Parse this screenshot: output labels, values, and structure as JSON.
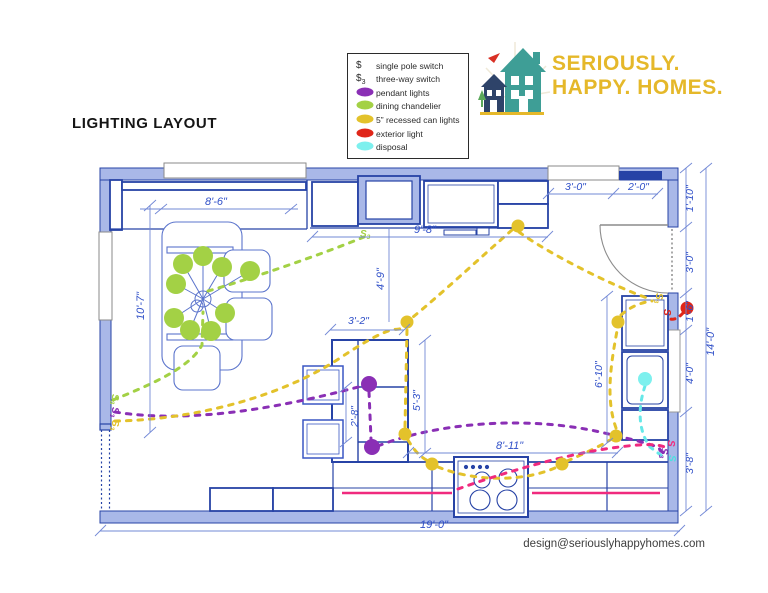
{
  "title": "LIGHTING LAYOUT",
  "legend": {
    "switch_items": [
      {
        "symbol": "$",
        "sub": "",
        "label": "single pole switch"
      },
      {
        "symbol": "$",
        "sub": "3",
        "label": "three-way switch"
      }
    ],
    "light_items": [
      {
        "label": "pendant lights",
        "color": "#8a2fb5"
      },
      {
        "label": "dining chandelier",
        "color": "#a3d145"
      },
      {
        "label": "5” recessed can lights",
        "color": "#e3c22b"
      },
      {
        "label": "exterior light",
        "color": "#e02619"
      },
      {
        "label": "disposal",
        "color": "#7df0ee"
      }
    ]
  },
  "logo": {
    "line1": "SERIOUSLY.",
    "line2": "HAPPY. HOMES."
  },
  "footer": {
    "email": "design@seriouslyhappyhomes.com"
  },
  "glyphs": {
    "s": "S",
    "three": "3"
  },
  "dims": {
    "top_left_window": "8'-6\"",
    "top_run": "9'-8\"",
    "left_wall": "10'-7\"",
    "entry_window_a": "3'-0\"",
    "entry_window_b": "2'-0\"",
    "right_top": "1'-10\"",
    "right_door": "3'-0\"",
    "right_exterior": "1'-6\"",
    "right_window": "4'-0\"",
    "right_bottom": "3'-8\"",
    "right_overall": "14'-0\"",
    "right_run": "6'-10\"",
    "hood_to_island": "4'-9\"",
    "island_width": "3'-2\"",
    "island_mid": "2'-8\"",
    "island_length": "5'-3\"",
    "bottom_run": "8'-11\"",
    "overall_width": "19'-0\""
  }
}
